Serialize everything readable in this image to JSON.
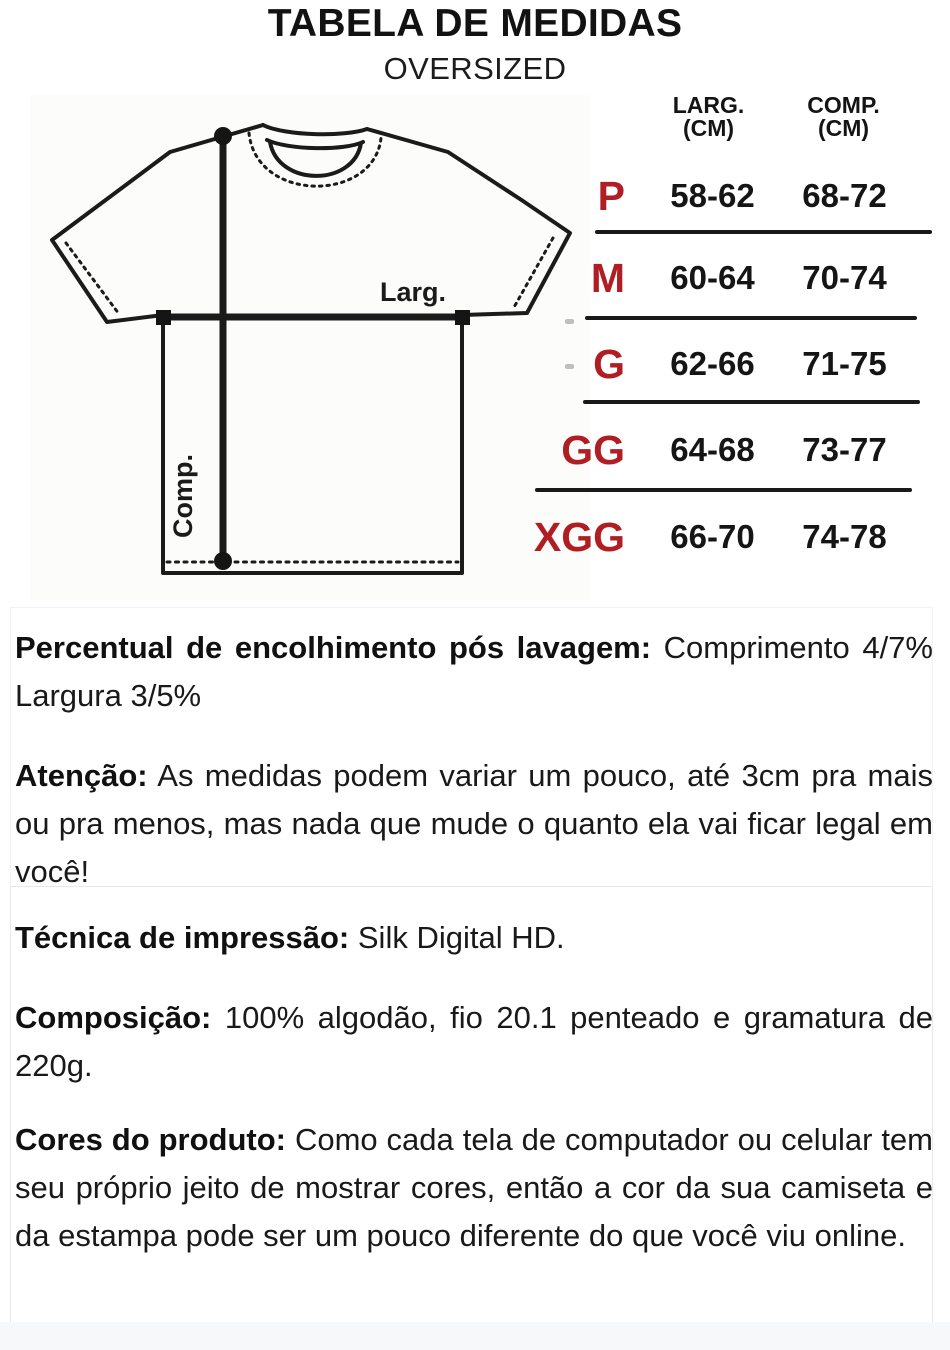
{
  "page": {
    "title": "TABELA DE MEDIDAS",
    "subtitle": "OVERSIZED"
  },
  "colors": {
    "size_accent": "#B01E23",
    "ink": "#1A1A1A"
  },
  "diagram": {
    "width_label": "Larg.",
    "length_label": "Comp."
  },
  "size_table": {
    "columns": [
      {
        "label": "LARG.",
        "unit": "(CM)"
      },
      {
        "label": "COMP.",
        "unit": "(CM)"
      }
    ],
    "rows": [
      {
        "size": "P",
        "larg": "58-62",
        "comp": "68-72"
      },
      {
        "size": "M",
        "larg": "60-64",
        "comp": "70-74"
      },
      {
        "size": "G",
        "larg": "62-66",
        "comp": "71-75"
      },
      {
        "size": "GG",
        "larg": "64-68",
        "comp": "73-77"
      },
      {
        "size": "XGG",
        "larg": "66-70",
        "comp": "74-78"
      }
    ]
  },
  "notes": {
    "shrinkage": {
      "label": "Percentual de encolhimento pós lavagem:",
      "text": "Comprimento 4/7% Largura 3/5%"
    },
    "attention": {
      "label": "Atenção:",
      "text": "As medidas podem variar um pouco, até 3cm pra mais ou pra menos, mas nada que mude o quanto ela vai ficar legal em você!"
    }
  },
  "product_info": {
    "technique": {
      "label": "Técnica de impressão:",
      "text": "Silk Digital HD."
    },
    "composition": {
      "label": "Composição:",
      "text": "100% algodão, fio 20.1 penteado e gramatura de 220g."
    },
    "colors_note": {
      "label": "Cores do produto:",
      "text": "Como cada tela de computador ou celular tem seu próprio jeito de mostrar cores, então a cor da sua camiseta e da estampa pode ser um pouco diferente do que você viu online."
    }
  }
}
